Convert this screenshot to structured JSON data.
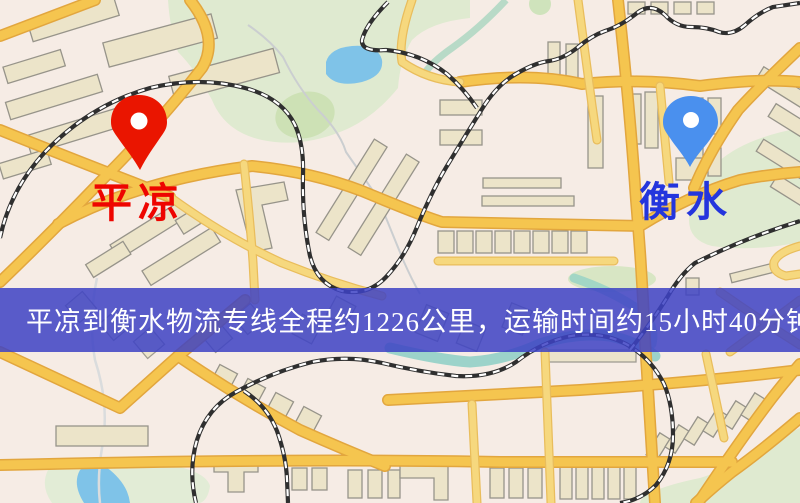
{
  "map": {
    "pins": {
      "origin": {
        "name": "平凉",
        "pin_color": "#ea1500",
        "label_color": "#ee0500"
      },
      "destination": {
        "name": "衡水",
        "pin_color": "#4a90ee",
        "label_color": "#2435dd"
      }
    },
    "banner": {
      "text": "平凉到衡水物流专线全程约1226公里，运输时间约15小时40分钟.",
      "bg": "#3d42c4",
      "text_color": "#ffffff"
    },
    "colors": {
      "background": "#f7f0e9",
      "road": "#f5c54f",
      "road_casing": "#e2a63e",
      "minor_road": "#f6d87e",
      "minor_road_casing": "#e9bd5c",
      "park": "#dfead0",
      "park_dark": "#cde1b5",
      "water": "#7fc3e8",
      "teal_river": "#8ccfc6",
      "railway": "#2f2f2f",
      "building": "#ece4c9",
      "building_stroke": "#97948a"
    }
  }
}
